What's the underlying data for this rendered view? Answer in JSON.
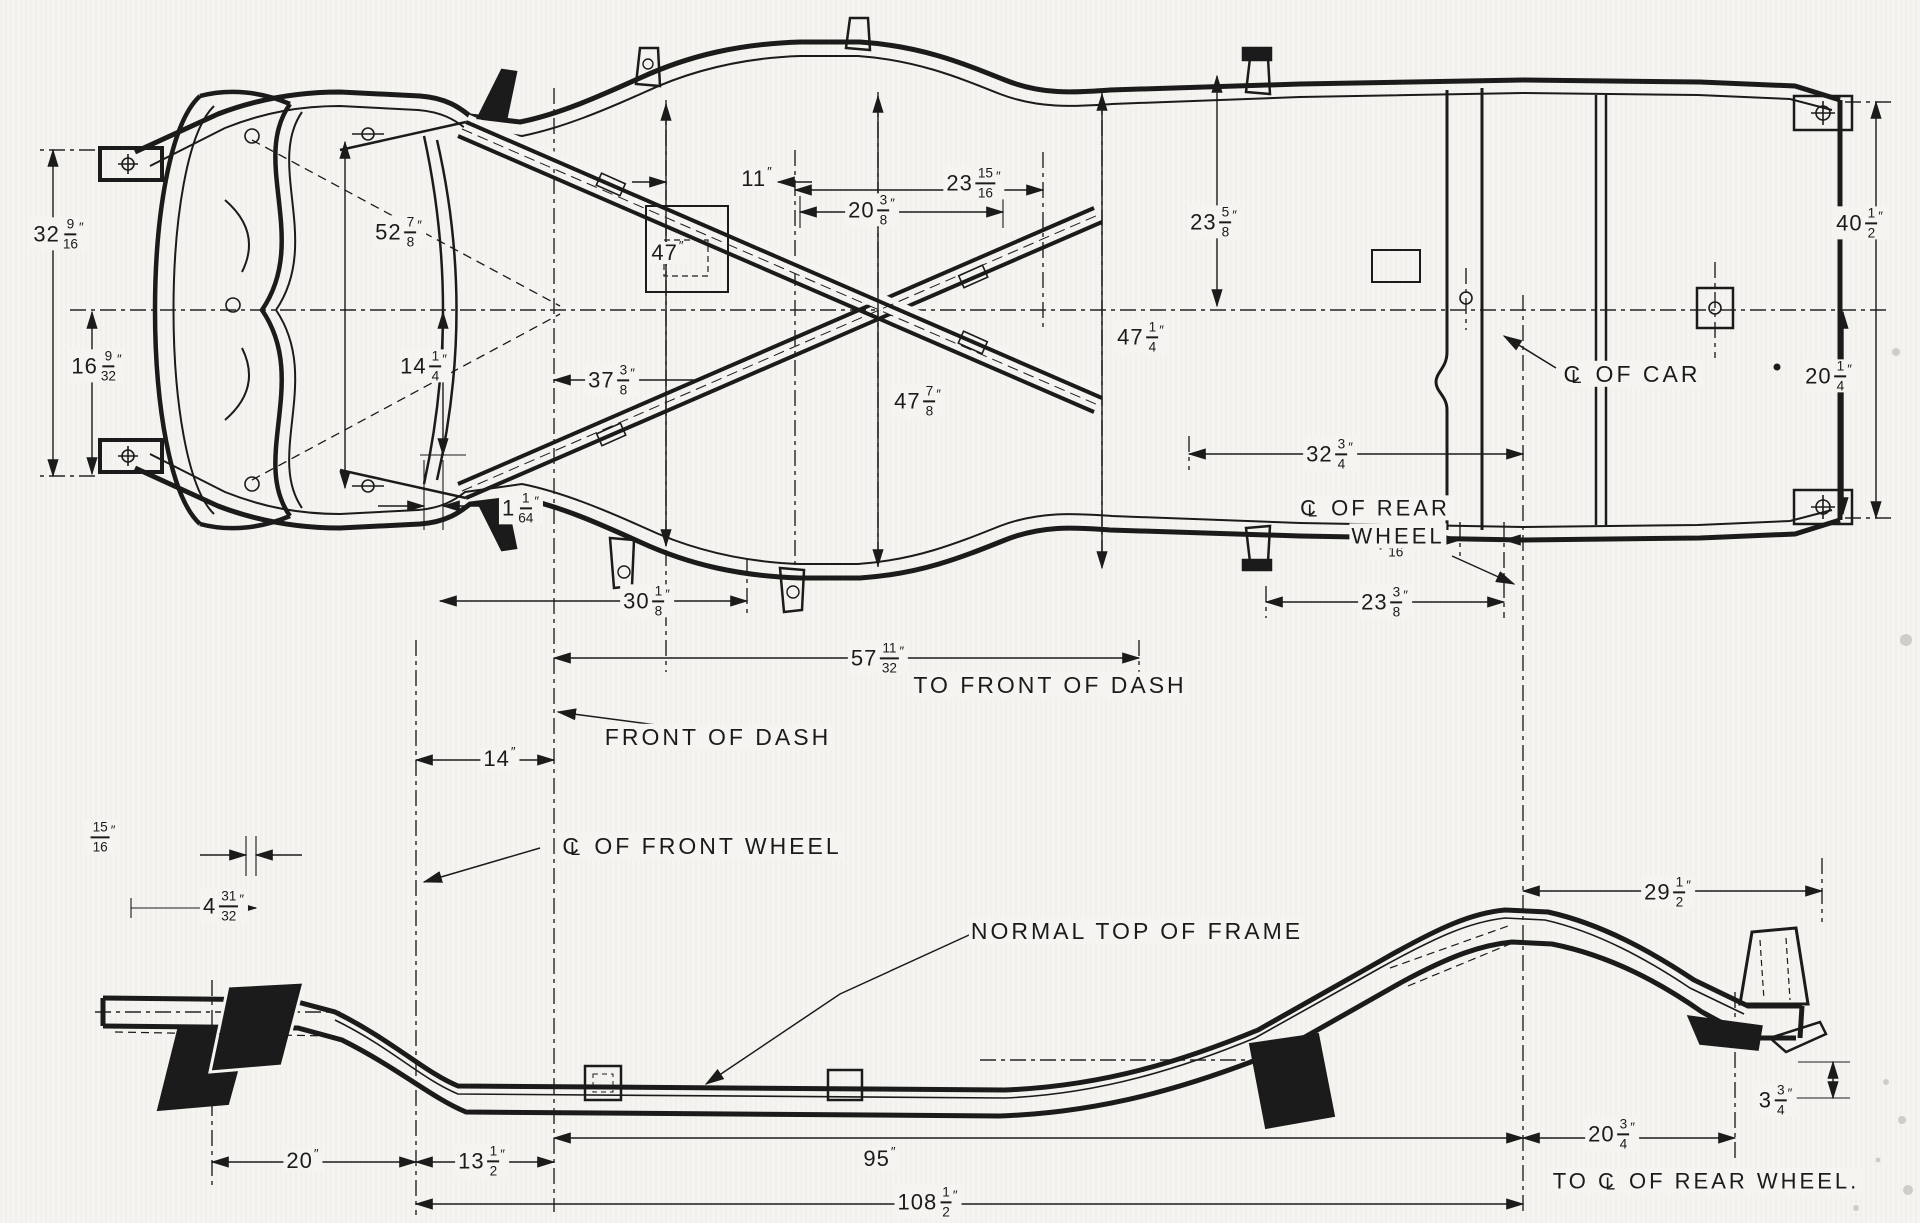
{
  "colors": {
    "paper": "#f5f4f0",
    "ink": "#1b1b1b"
  },
  "drawing_type": "vintage car chassis frame engineering drawing, plan view and side elevation",
  "dimensions": [
    {
      "id": "front-width-overall",
      "whole": "32",
      "num": "9",
      "den": "16",
      "unit": "″",
      "x": 59,
      "y": 234
    },
    {
      "id": "front-half-width",
      "whole": "16",
      "num": "9",
      "den": "32",
      "unit": "″",
      "x": 97,
      "y": 366
    },
    {
      "id": "width-at-front-spring",
      "whole": "52",
      "num": "7",
      "den": "8",
      "unit": "″",
      "x": 399,
      "y": 232
    },
    {
      "id": "width-47",
      "whole": "47",
      "num": "",
      "den": "",
      "unit": "″",
      "x": 668,
      "y": 253
    },
    {
      "id": "offset-11",
      "whole": "11",
      "num": "",
      "den": "",
      "unit": "″",
      "x": 757,
      "y": 179
    },
    {
      "id": "offset-20-3-8",
      "whole": "20",
      "num": "3",
      "den": "8",
      "unit": "″",
      "x": 872,
      "y": 210
    },
    {
      "id": "half-width-23-15-16",
      "whole": "23",
      "num": "15",
      "den": "16",
      "unit": "″",
      "x": 974,
      "y": 183
    },
    {
      "id": "half-width-23-5-8",
      "whole": "23",
      "num": "5",
      "den": "8",
      "unit": "″",
      "x": 1214,
      "y": 222
    },
    {
      "id": "width-47-1-4",
      "whole": "47",
      "num": "1",
      "den": "4",
      "unit": "″",
      "x": 1141,
      "y": 337
    },
    {
      "id": "width-47-7-8",
      "whole": "47",
      "num": "7",
      "den": "8",
      "unit": "″",
      "x": 918,
      "y": 401
    },
    {
      "id": "half-width-14-1-4",
      "whole": "14",
      "num": "1",
      "den": "4",
      "unit": "″",
      "x": 424,
      "y": 366
    },
    {
      "id": "offset-37-3-8",
      "whole": "37",
      "num": "3",
      "den": "8",
      "unit": "″",
      "x": 612,
      "y": 380
    },
    {
      "id": "rear-width-overall",
      "whole": "40",
      "num": "1",
      "den": "2",
      "unit": "″",
      "x": 1860,
      "y": 223
    },
    {
      "id": "rear-half-width",
      "whole": "20",
      "num": "1",
      "den": "4",
      "unit": "″",
      "x": 1829,
      "y": 376
    },
    {
      "id": "gap-1-1-64",
      "whole": "1",
      "num": "1",
      "den": "64",
      "unit": "″",
      "x": 521,
      "y": 508
    },
    {
      "id": "offset-4-5-16",
      "whole": "4",
      "num": "5",
      "den": "16",
      "unit": "″",
      "x": 1391,
      "y": 542
    },
    {
      "id": "offset-23-3-8",
      "whole": "23",
      "num": "3",
      "den": "8",
      "unit": "″",
      "x": 1385,
      "y": 602
    },
    {
      "id": "offset-32-3-4",
      "whole": "32",
      "num": "3",
      "den": "4",
      "unit": "″",
      "x": 1330,
      "y": 454
    },
    {
      "id": "offset-30-1-8",
      "whole": "30",
      "num": "1",
      "den": "8",
      "unit": "″",
      "x": 647,
      "y": 601
    },
    {
      "id": "offset-57-11-32",
      "whole": "57",
      "num": "11",
      "den": "32",
      "unit": "″",
      "x": 878,
      "y": 658
    },
    {
      "id": "offset-14",
      "whole": "14",
      "num": "",
      "den": "",
      "unit": "″",
      "x": 500,
      "y": 759
    },
    {
      "id": "offset-15-16",
      "whole": "",
      "num": "15",
      "den": "16",
      "unit": "″",
      "x": 102,
      "y": 837
    },
    {
      "id": "offset-4-31-32",
      "whole": "4",
      "num": "31",
      "den": "32",
      "unit": "″",
      "x": 224,
      "y": 906
    },
    {
      "id": "rear-overhang-29-1-2",
      "whole": "29",
      "num": "1",
      "den": "2",
      "unit": "″",
      "x": 1668,
      "y": 892
    },
    {
      "id": "height-3-3-4",
      "whole": "3",
      "num": "3",
      "den": "4",
      "unit": "″",
      "x": 1776,
      "y": 1100
    },
    {
      "id": "rear-20-3-4",
      "whole": "20",
      "num": "3",
      "den": "4",
      "unit": "″",
      "x": 1612,
      "y": 1134
    },
    {
      "id": "front-20",
      "whole": "20",
      "num": "",
      "den": "",
      "unit": "″",
      "x": 303,
      "y": 1161
    },
    {
      "id": "front-13-1-2",
      "whole": "13",
      "num": "1",
      "den": "2",
      "unit": "″",
      "x": 482,
      "y": 1161
    },
    {
      "id": "span-95",
      "whole": "95",
      "num": "",
      "den": "",
      "unit": "″",
      "x": 880,
      "y": 1159
    },
    {
      "id": "wheelbase-108-1-2",
      "whole": "108",
      "num": "1",
      "den": "2",
      "unit": "″",
      "x": 928,
      "y": 1202
    }
  ],
  "notes": [
    {
      "id": "to-front-of-dash",
      "text": "TO FRONT OF DASH",
      "x": 1050,
      "y": 685,
      "size": 23
    },
    {
      "id": "front-of-dash",
      "text": "FRONT OF DASH",
      "x": 718,
      "y": 737,
      "size": 23
    },
    {
      "id": "cl-of-car",
      "text": "℄ OF CAR",
      "x": 1632,
      "y": 374,
      "size": 23
    },
    {
      "id": "cl-of-rear-wheel-1",
      "text": "℄ OF REAR",
      "x": 1375,
      "y": 508,
      "size": 22
    },
    {
      "id": "cl-of-rear-wheel-2",
      "text": "WHEEL",
      "x": 1398,
      "y": 536,
      "size": 22
    },
    {
      "id": "cl-of-front-wheel",
      "text": "℄ OF FRONT WHEEL",
      "x": 702,
      "y": 846,
      "size": 23
    },
    {
      "id": "normal-top-of-frame",
      "text": "NORMAL TOP OF FRAME",
      "x": 1137,
      "y": 931,
      "size": 23
    },
    {
      "id": "to-cl-of-rear-wheel",
      "text": "TO ℄ OF REAR WHEEL.",
      "x": 1706,
      "y": 1181,
      "size": 22
    }
  ]
}
